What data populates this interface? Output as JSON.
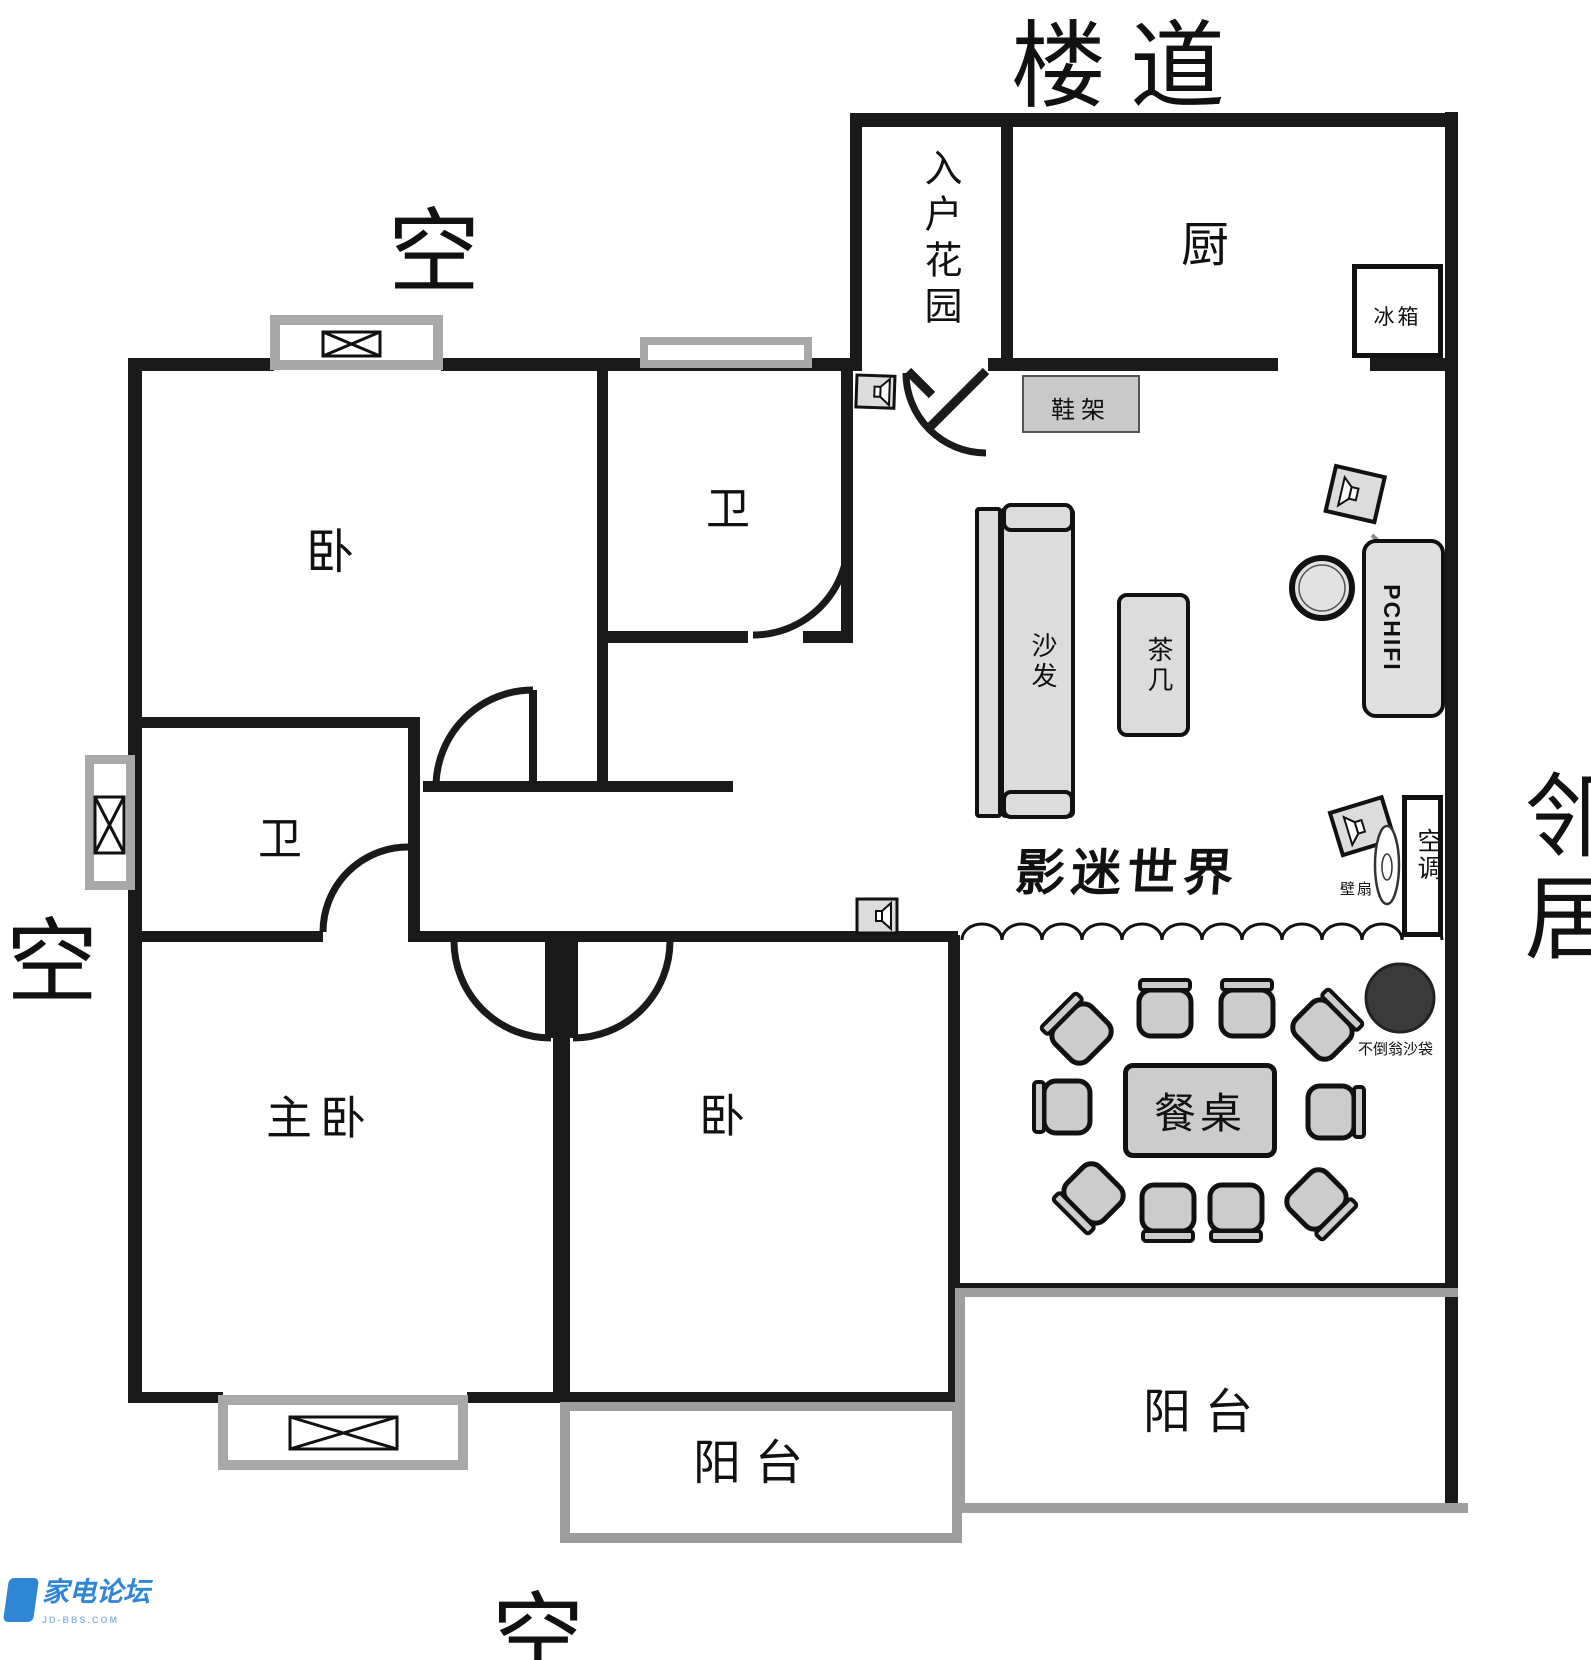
{
  "outside": {
    "corridor": "楼道",
    "void_top": "空",
    "void_left": "空",
    "void_bottom": "空",
    "neighbor": "邻居"
  },
  "rooms": {
    "entry_garden": "入户花园",
    "kitchen": "厨",
    "bath_top": "卫",
    "bath_mid": "卫",
    "bedroom_top": "卧",
    "bedroom_mid": "卧",
    "master_bedroom": "主卧",
    "balcony_mid": "阳台",
    "balcony_right": "阳台"
  },
  "furniture": {
    "fridge": "冰箱",
    "shoe_rack": "鞋架",
    "sofa": "沙发",
    "tea_table": "茶几",
    "dining_table": "餐桌",
    "pc_hifi": "PCHIFI",
    "aircon": "空调",
    "wall_fan": "壁扇",
    "tumbler_sandbag": "不倒翁沙袋",
    "cinema_caption": "影迷世界"
  },
  "watermark": {
    "title": "家电论坛",
    "subtitle": "JD-BBS.COM"
  },
  "colors": {
    "wall": "#1a1a1a",
    "gray_wall": "#9e9e9e",
    "furniture_fill": "#dcdcdc",
    "sandbag": "#3a3a3a",
    "watermark_blue": "#2e86d5"
  }
}
